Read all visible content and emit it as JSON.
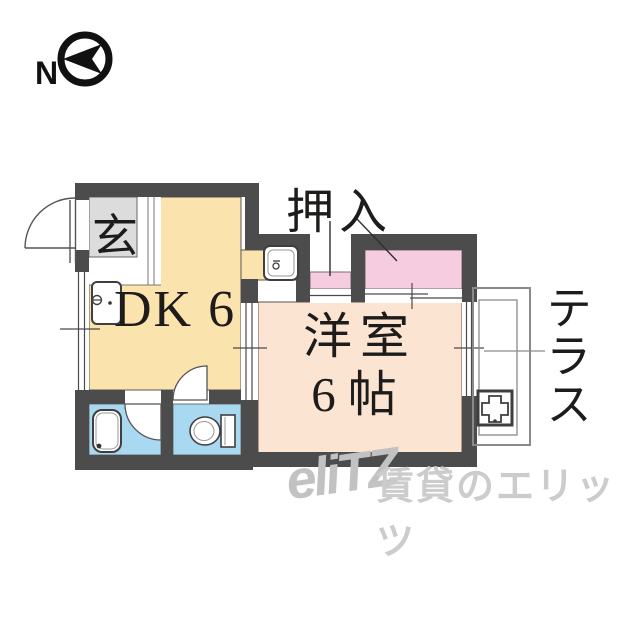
{
  "compass": {
    "label": "N"
  },
  "rooms": {
    "entrance": {
      "label": "玄",
      "floor_color": "#dcdcdc"
    },
    "dk": {
      "label": "DK 6",
      "floor_color": "#fbe3ae"
    },
    "western": {
      "name": "洋室",
      "size": "6帖",
      "floor_color": "#fce4d3"
    },
    "closet": {
      "label": "押入",
      "floor_color": "#f6cce0"
    },
    "terrace": {
      "label": "テラス"
    },
    "bath_toilet": {
      "floor_color": "#a9d9f1"
    }
  },
  "colors": {
    "wall": "#4c4c4c"
  },
  "watermark": {
    "logo": "eliTZ",
    "text": "賃貸のエリッツ"
  }
}
